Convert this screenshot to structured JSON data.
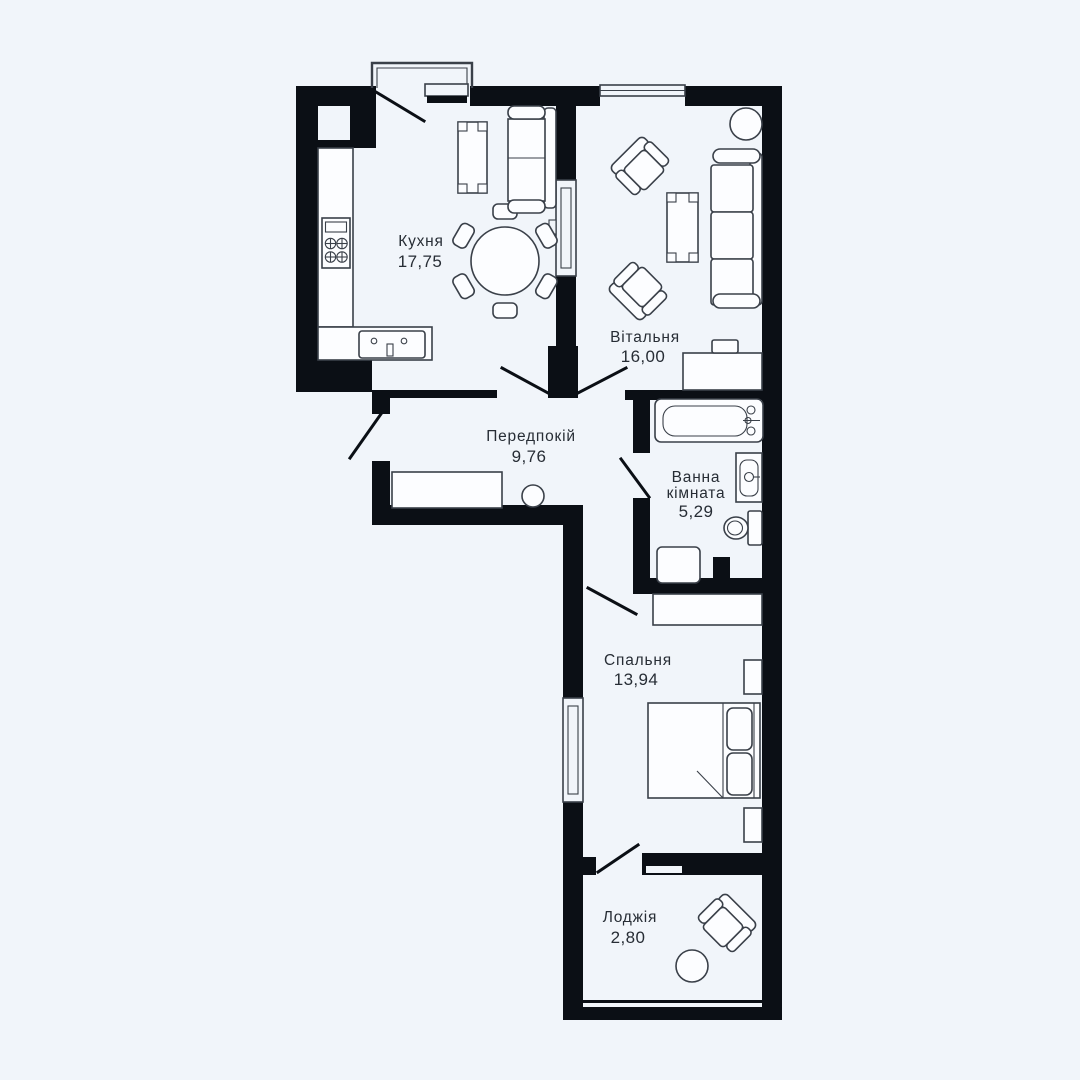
{
  "page": {
    "background": "#f1f5fa"
  },
  "palette": {
    "wall": "#0b0f15",
    "furniture_line": "#3a4049",
    "room_fill": "#fcfdff",
    "text": "#272d35"
  },
  "rooms": [
    {
      "id": "kitchen",
      "name": "Кухня",
      "area": "17,75"
    },
    {
      "id": "living_room",
      "name": "Вітальня",
      "area": "16,00"
    },
    {
      "id": "hallway",
      "name": "Передпокій",
      "area": "9,76"
    },
    {
      "id": "bathroom",
      "name_line1": "Ванна",
      "name_line2": "кімната",
      "area": "5,29"
    },
    {
      "id": "bedroom",
      "name": "Спальня",
      "area": "13,94"
    },
    {
      "id": "loggia",
      "name": "Лоджія",
      "area": "2,80"
    }
  ]
}
